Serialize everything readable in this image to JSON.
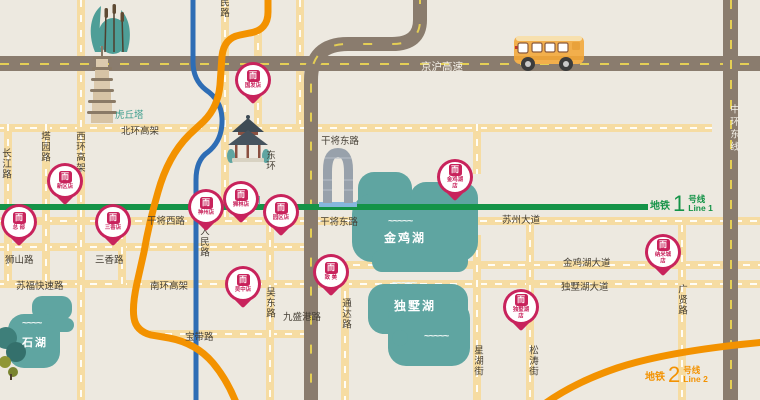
{
  "roads": {
    "jinghu": "京沪高速",
    "zhonghuan_dong": "中环东线",
    "beihuan": "北环高架",
    "xihuan": "西环高架",
    "changjiang": "长江路",
    "tayuan": "塔园路",
    "minlu_partial": "民路",
    "renmin": "人民路",
    "donghuan": "东环",
    "ganjiang_xi": "干将西路",
    "ganjiang_dong_north": "干将东路",
    "ganjiang_dong": "干将东路",
    "suzhou_dadao": "苏州大道",
    "shishan": "狮山路",
    "sanxiang": "三香路",
    "sufu": "苏福快速路",
    "nanhuan": "南环高架",
    "baodai": "宝带路",
    "jiushenggang": "九盛港路",
    "wudong": "吴东路",
    "tongda": "通达路",
    "xinghu": "星湖街",
    "songtao": "松涛街",
    "jinjihu_dadao": "金鸡湖大道",
    "dushuhu_dadao": "独墅湖大道",
    "guangxian": "广贤路"
  },
  "landmarks": {
    "huqiu_pagoda": "虎丘塔",
    "zhuozheng_garden": "拙政园"
  },
  "lakes": {
    "jinjihu": "金鸡湖",
    "dushuhu": "独墅湖",
    "shihu": "石湖"
  },
  "metro": {
    "line1": {
      "prefix": "地铁",
      "number": "1",
      "suffix": "号线",
      "en": "Line 1",
      "color": "#149347"
    },
    "line2": {
      "prefix": "地铁",
      "number": "2",
      "suffix": "号线",
      "en": "Line 2",
      "color": "#F39200"
    }
  },
  "brand": {
    "logo_glyph": "而"
  },
  "stores": [
    {
      "line1": "总 部"
    },
    {
      "line1": "新区店"
    },
    {
      "line1": "三香店"
    },
    {
      "line1": "国发店"
    },
    {
      "line1": "神州店"
    },
    {
      "line1": "狮林店"
    },
    {
      "line1": "园区店"
    },
    {
      "line1": "金鸡湖",
      "line2": "店"
    },
    {
      "line1": "吴中店"
    },
    {
      "line1": "致 美"
    },
    {
      "line1": "纳米城",
      "line2": "店"
    },
    {
      "line1": "独墅湖",
      "line2": "店"
    }
  ],
  "colors": {
    "background": "#EDE9E0",
    "road_yellow": "#F6DCA2",
    "road_gray": "#8A7C6E",
    "lake_teal": "#5FA5A1",
    "pin_crimson": "#C8235C",
    "metro_line1_green": "#149347",
    "metro_line2_orange": "#F39200",
    "river_blue": "#2E6DB5"
  }
}
